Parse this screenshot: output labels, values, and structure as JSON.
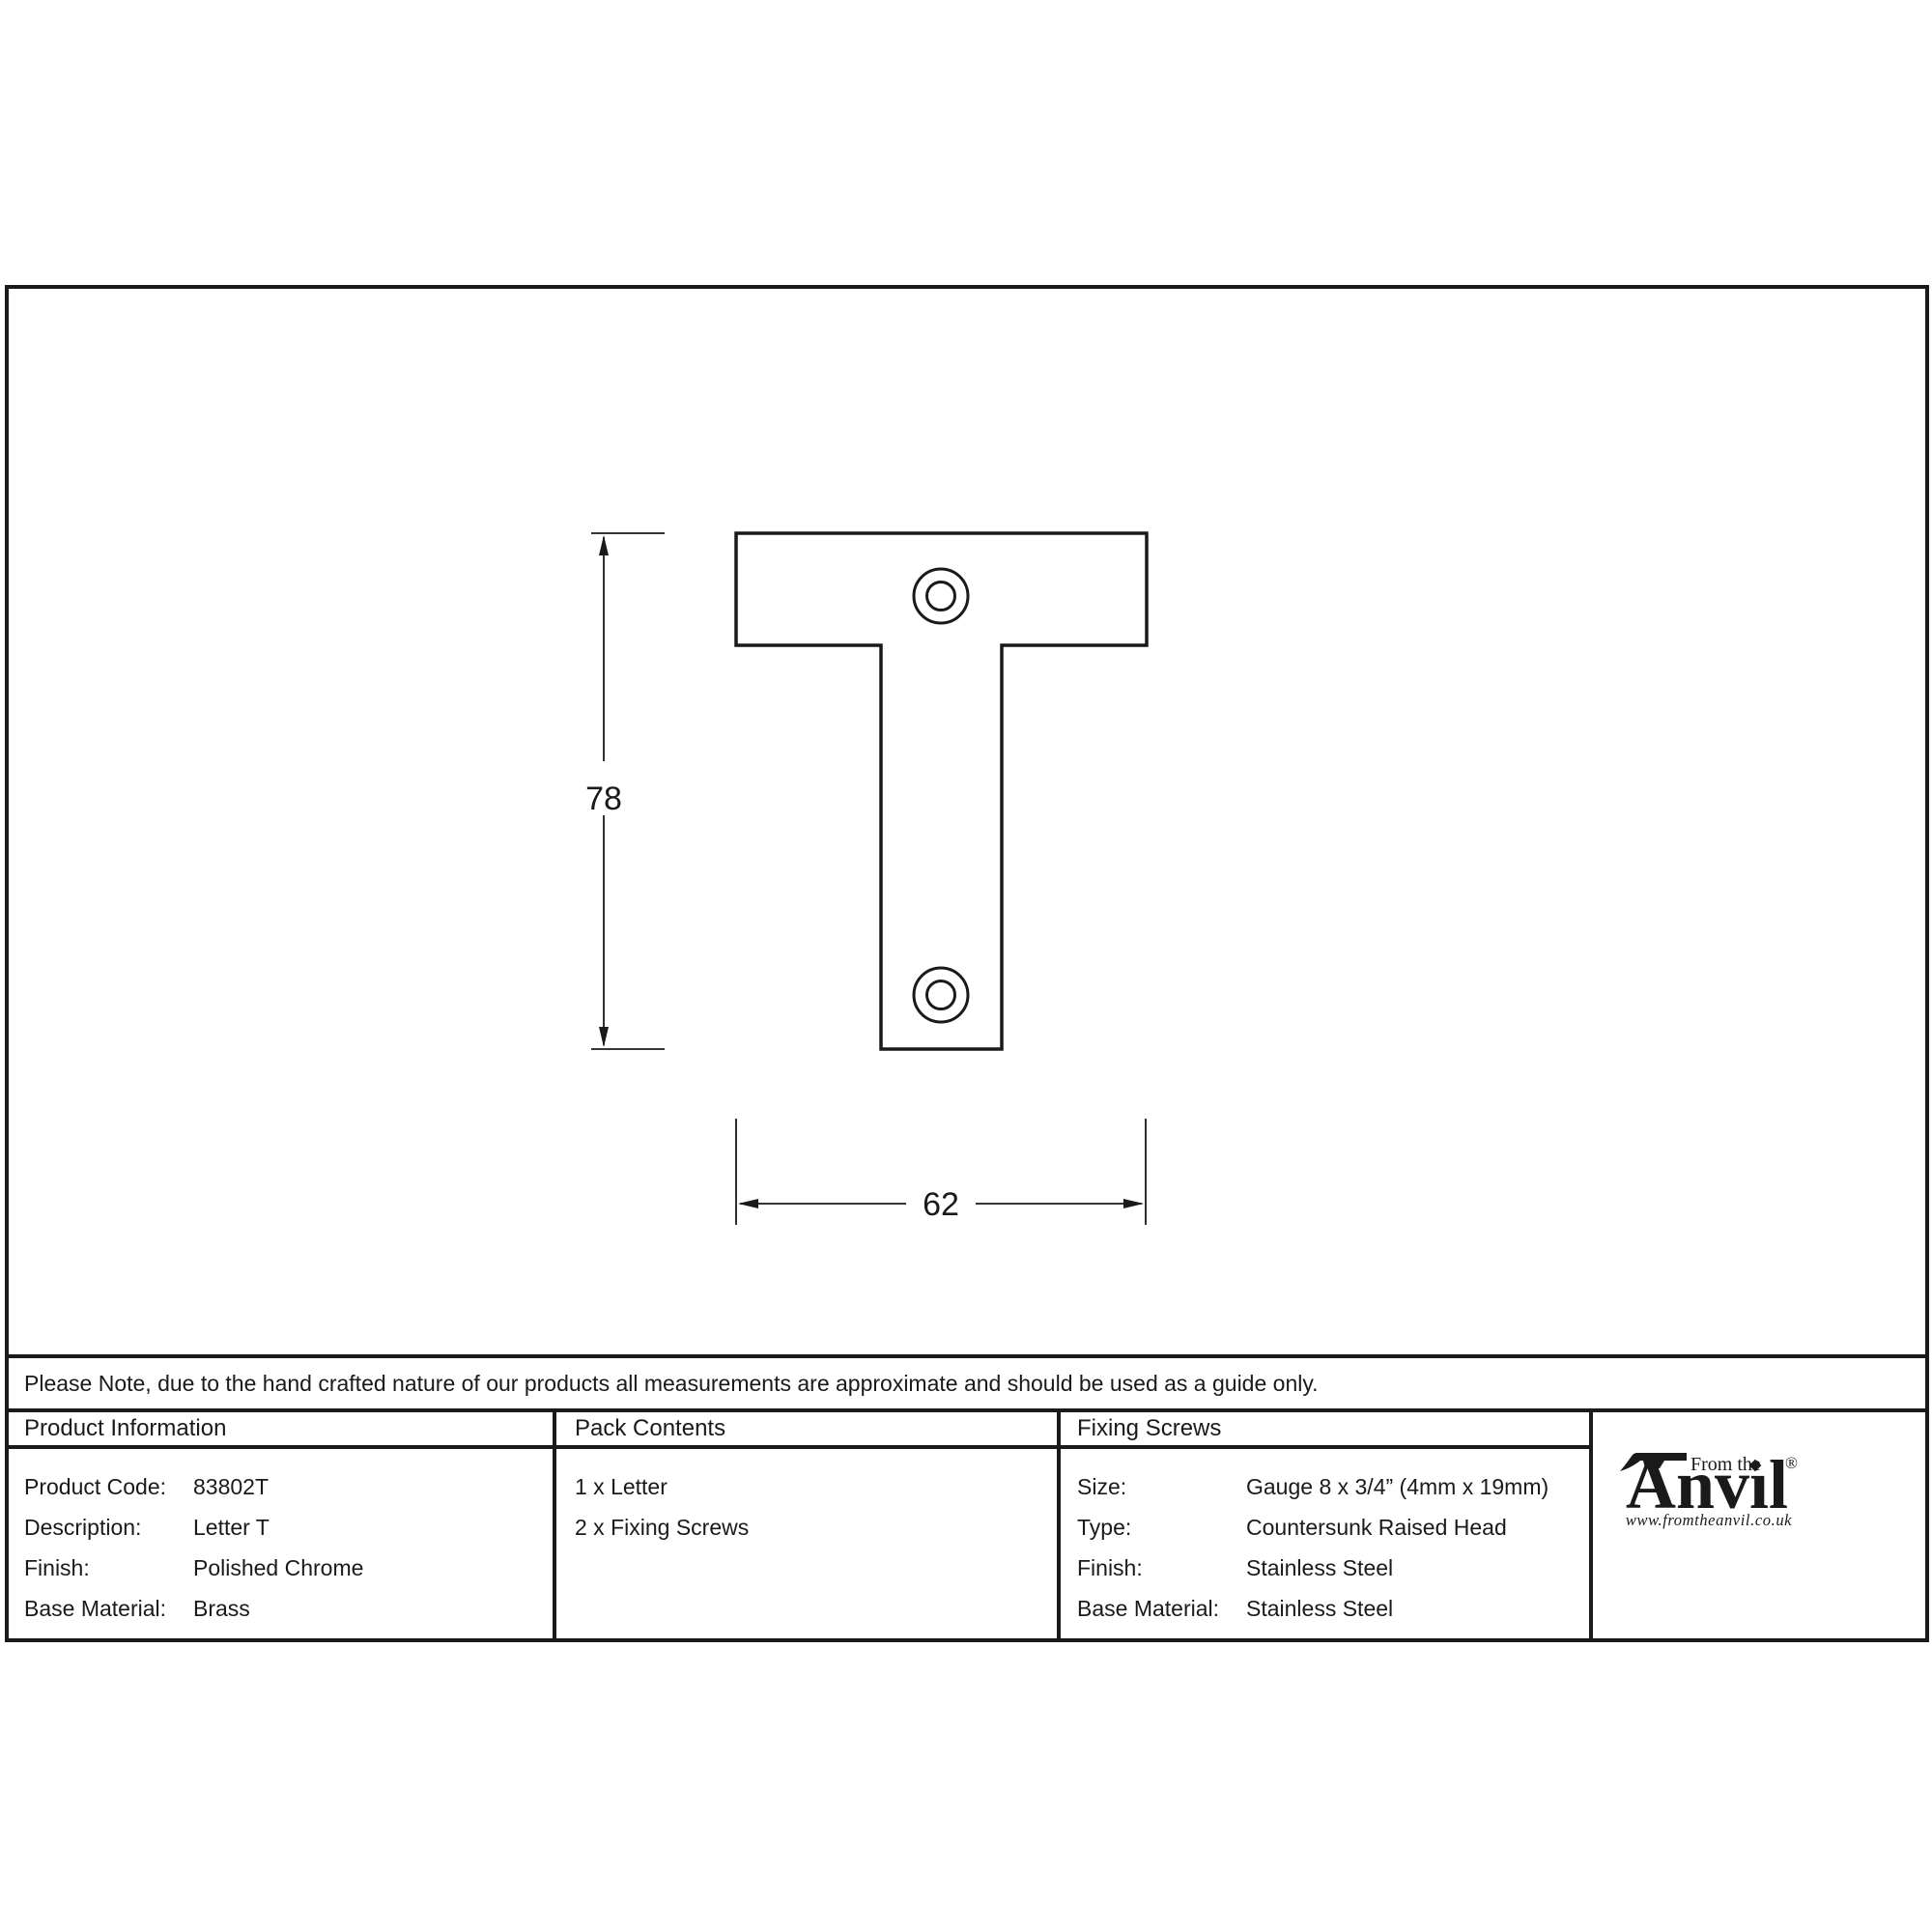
{
  "drawing": {
    "part_name": "Letter T",
    "height_label": "78",
    "width_label": "62",
    "screw_holes": 2
  },
  "note": "Please Note, due to the hand crafted nature of our products all measurements are approximate and should be used as a guide only.",
  "table": {
    "product_information": {
      "header": "Product Information",
      "rows": [
        {
          "label": "Product Code:",
          "value": "83802T"
        },
        {
          "label": "Description:",
          "value": "Letter T"
        },
        {
          "label": "Finish:",
          "value": "Polished Chrome"
        },
        {
          "label": "Base Material:",
          "value": "Brass"
        }
      ]
    },
    "pack_contents": {
      "header": "Pack Contents",
      "items": [
        "1 x Letter",
        "2 x Fixing Screws"
      ]
    },
    "fixing_screws": {
      "header": "Fixing Screws",
      "rows": [
        {
          "label": "Size:",
          "value": "Gauge 8 x 3/4” (4mm x 19mm)"
        },
        {
          "label": "Type:",
          "value": "Countersunk Raised Head"
        },
        {
          "label": "Finish:",
          "value": "Stainless Steel"
        },
        {
          "label": "Base Material:",
          "value": "Stainless Steel"
        }
      ]
    }
  },
  "logo": {
    "from_the": "From the",
    "big_a": "A",
    "rest": "nvıl",
    "registered": "®",
    "url": "www.fromtheanvil.co.uk"
  },
  "colors": {
    "ink": "#1a1a1a",
    "background": "#ffffff"
  }
}
